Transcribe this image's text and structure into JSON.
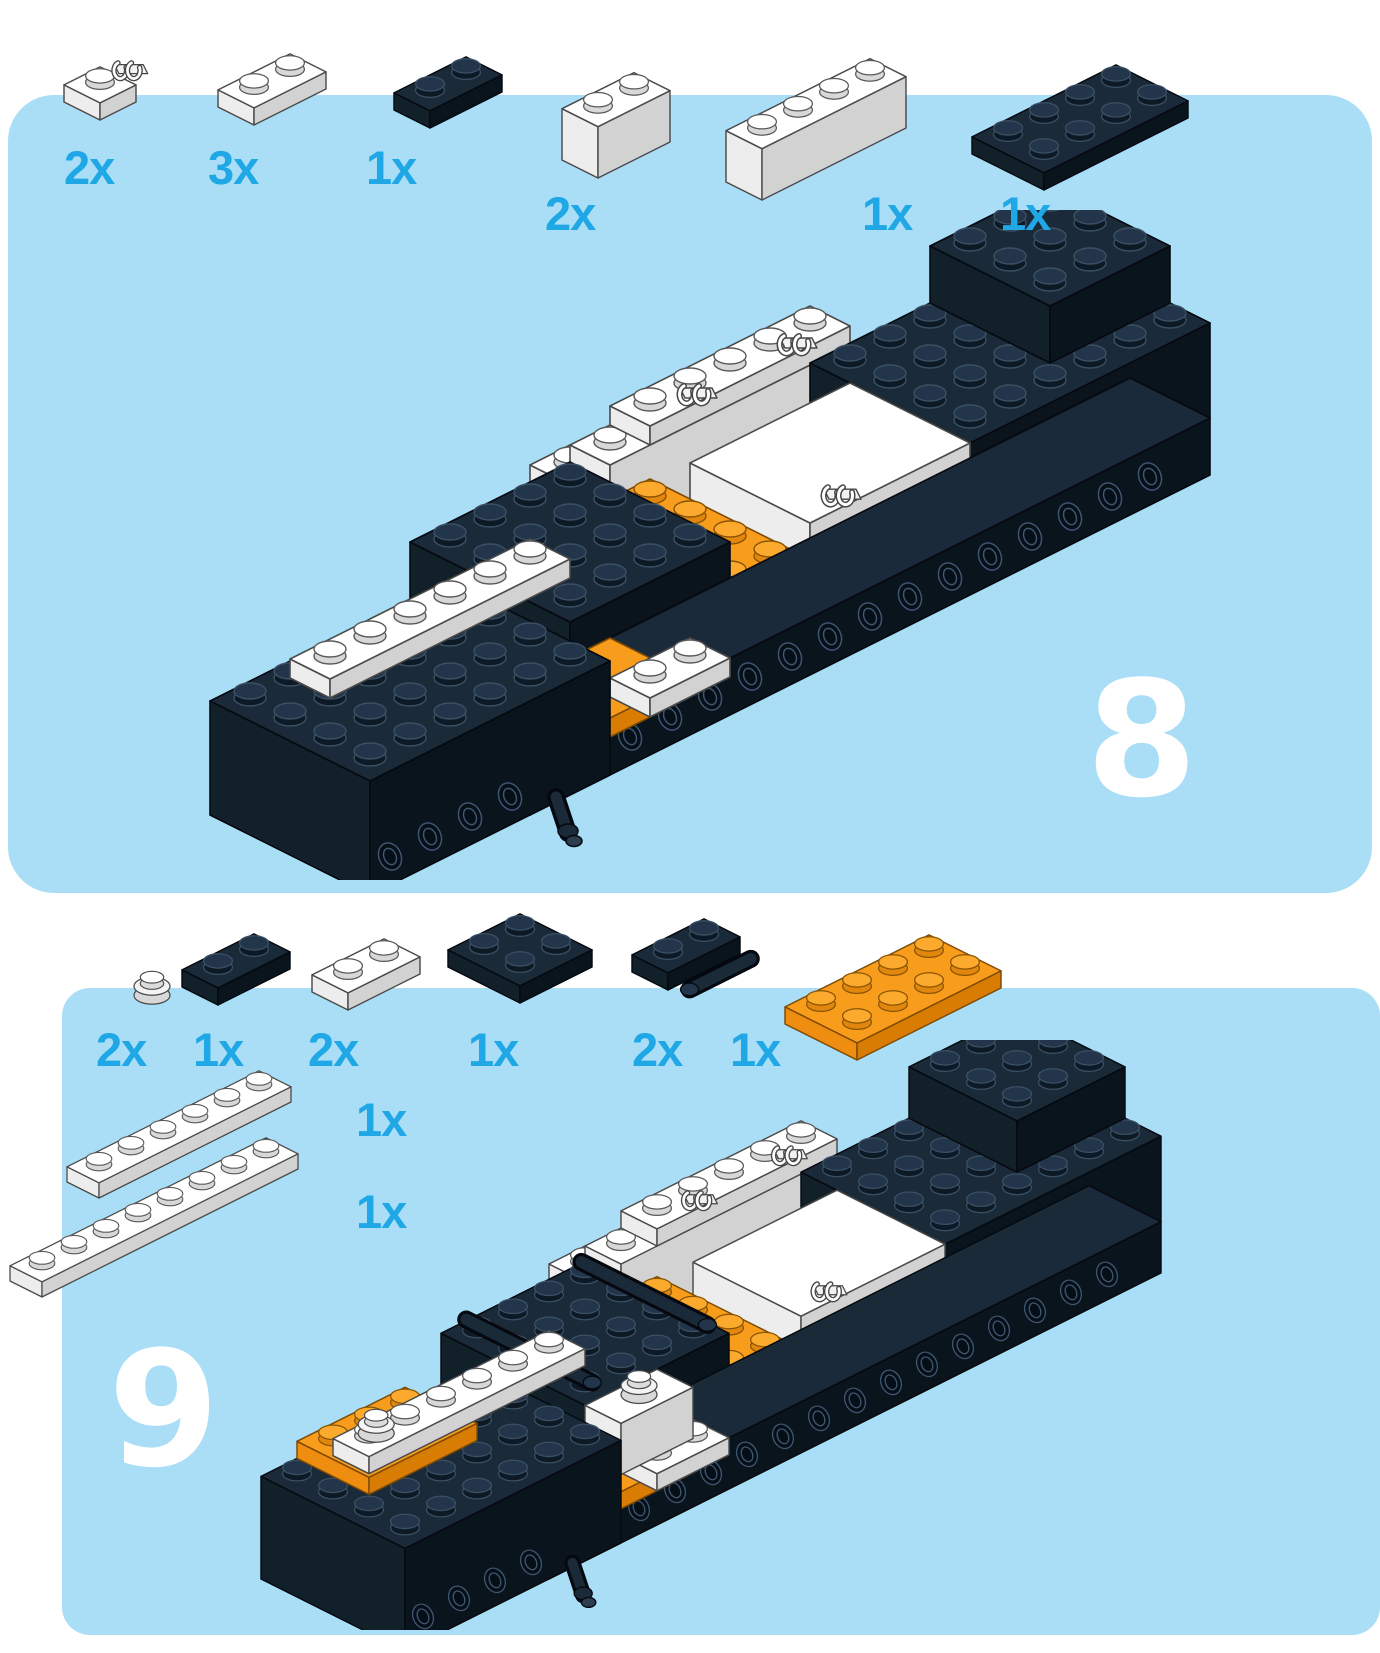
{
  "document": {
    "kind": "lego-building-instructions-page",
    "panel_color": "#a9def6",
    "count_label_color": "#20a7e5",
    "step_number_color": "#ffffff",
    "brick_colors": {
      "dark_navy": "#13222f",
      "white": "#ffffff",
      "orange": "#f79b1c"
    }
  },
  "steps": [
    {
      "number": "8",
      "parts": [
        {
          "id": "white-plate-1x1-with-clip",
          "count": "2x"
        },
        {
          "id": "white-plate-1x2",
          "count": "3x"
        },
        {
          "id": "black-plate-1x2",
          "count": "1x"
        },
        {
          "id": "white-brick-1x2",
          "count": "2x"
        },
        {
          "id": "white-brick-1x4",
          "count": "1x"
        },
        {
          "id": "black-plate-2x4",
          "count": "1x"
        }
      ]
    },
    {
      "number": "9",
      "parts": [
        {
          "id": "white-round-plate-1x1",
          "count": "2x"
        },
        {
          "id": "black-plate-1x2",
          "count": "1x"
        },
        {
          "id": "white-plate-1x2",
          "count": "2x"
        },
        {
          "id": "black-plate-2x2",
          "count": "1x"
        },
        {
          "id": "black-plate-1x2-with-handle",
          "count": "2x"
        },
        {
          "id": "orange-plate-2x4",
          "count": "1x"
        },
        {
          "id": "white-plate-1x6",
          "count": "1x"
        },
        {
          "id": "white-plate-1x8",
          "count": "1x"
        }
      ]
    }
  ]
}
